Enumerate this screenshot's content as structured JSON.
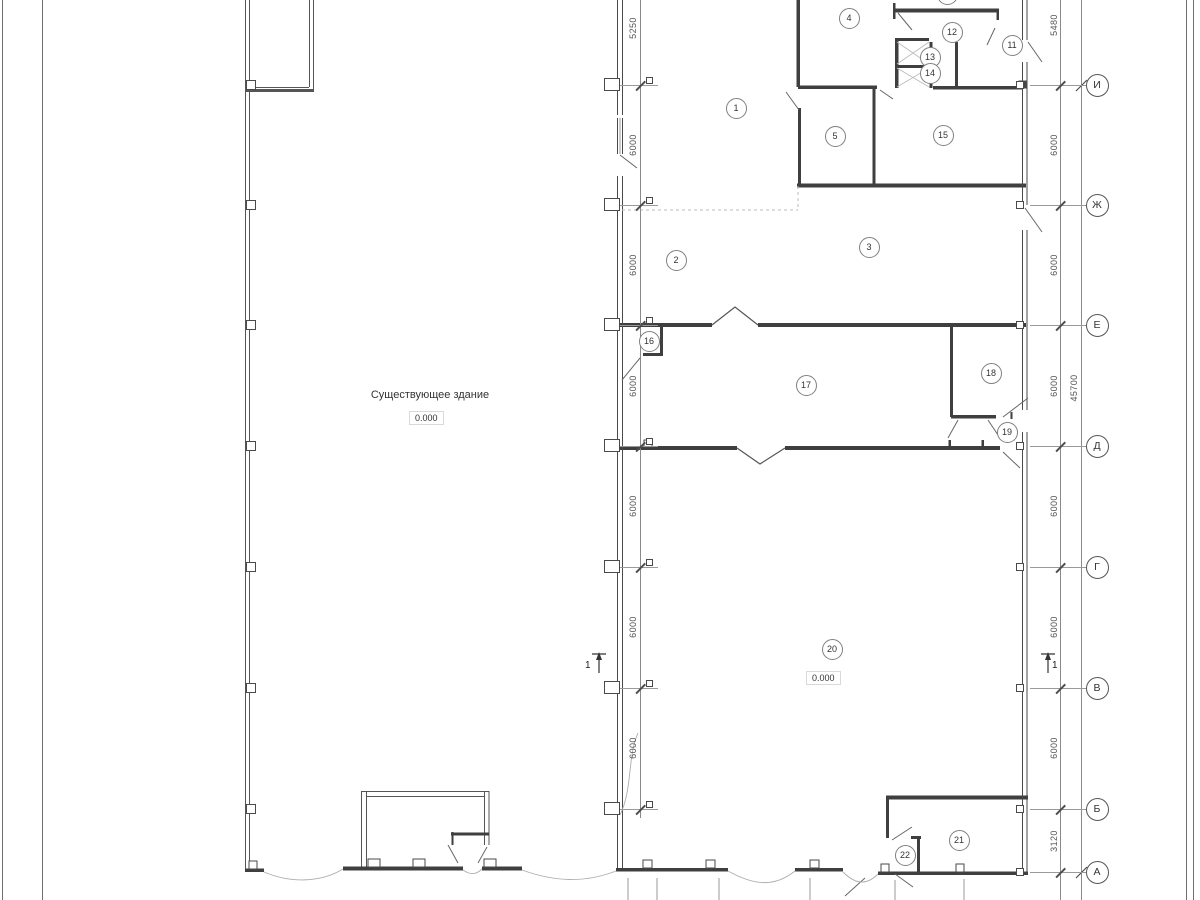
{
  "drawing": {
    "existing_building_label": "Существующее здание",
    "existing_building_elevation": "0.000",
    "hall_elevation": "0.000",
    "section_label": "1"
  },
  "rooms": [
    {
      "n": "1",
      "x": 736,
      "y": 108
    },
    {
      "n": "2",
      "x": 676,
      "y": 260
    },
    {
      "n": "3",
      "x": 869,
      "y": 247
    },
    {
      "n": "4",
      "x": 849,
      "y": 18
    },
    {
      "n": "5",
      "x": 835,
      "y": 136
    },
    {
      "n": "",
      "x": 947,
      "y": -6
    },
    {
      "n": "11",
      "x": 1012,
      "y": 45
    },
    {
      "n": "12",
      "x": 952,
      "y": 32
    },
    {
      "n": "13",
      "x": 930,
      "y": 57
    },
    {
      "n": "14",
      "x": 930,
      "y": 73
    },
    {
      "n": "15",
      "x": 943,
      "y": 135
    },
    {
      "n": "16",
      "x": 649,
      "y": 341
    },
    {
      "n": "17",
      "x": 806,
      "y": 385
    },
    {
      "n": "18",
      "x": 991,
      "y": 373
    },
    {
      "n": "19",
      "x": 1007,
      "y": 432
    },
    {
      "n": "20",
      "x": 832,
      "y": 649
    },
    {
      "n": "21",
      "x": 959,
      "y": 840
    },
    {
      "n": "22",
      "x": 905,
      "y": 855
    }
  ],
  "axes": [
    {
      "label": "И",
      "y": 85
    },
    {
      "label": "Ж",
      "y": 205
    },
    {
      "label": "Е",
      "y": 325
    },
    {
      "label": "Д",
      "y": 446
    },
    {
      "label": "Г",
      "y": 567
    },
    {
      "label": "В",
      "y": 688
    },
    {
      "label": "Б",
      "y": 809
    },
    {
      "label": "А",
      "y": 872
    }
  ],
  "left_dims": [
    {
      "text": "5250",
      "y": 28
    },
    {
      "text": "6000",
      "y": 145
    },
    {
      "text": "6000",
      "y": 265
    },
    {
      "text": "6000",
      "y": 386
    },
    {
      "text": "6000",
      "y": 506
    },
    {
      "text": "6000",
      "y": 627
    },
    {
      "text": "6000",
      "y": 748
    }
  ],
  "right_dims": [
    {
      "text": "5480",
      "y": 25
    },
    {
      "text": "6000",
      "y": 145
    },
    {
      "text": "6000",
      "y": 265
    },
    {
      "text": "6000",
      "y": 386
    },
    {
      "text": "6000",
      "y": 506
    },
    {
      "text": "6000",
      "y": 627
    },
    {
      "text": "6000",
      "y": 748
    },
    {
      "text": "3120",
      "y": 841
    }
  ],
  "overall_dim": {
    "text": "45700",
    "y": 388
  },
  "colors": {
    "wall": "#3f3f3f",
    "thin_line": "#6a6a6a",
    "leader": "#9a9a9a",
    "text": "#333333",
    "break_line": "#adadad"
  }
}
